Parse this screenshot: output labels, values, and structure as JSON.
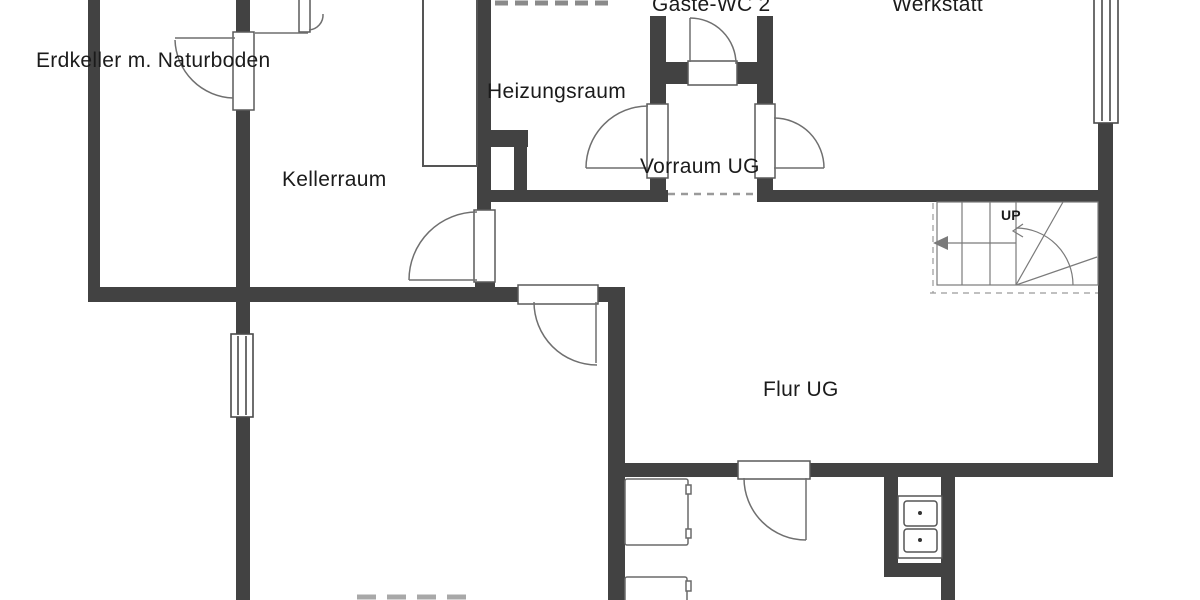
{
  "plan_type": "floor-plan",
  "rooms": {
    "erdkeller": {
      "label": "Erdkeller m. Naturboden"
    },
    "kellerraum": {
      "label": "Kellerraum"
    },
    "heizungsraum": {
      "label": "Heizungsraum"
    },
    "gaeste_wc": {
      "label": "Gäste-WC 2"
    },
    "werkstatt": {
      "label": "Werkstatt"
    },
    "vorraum": {
      "label": "Vorraum UG"
    },
    "flur": {
      "label": "Flur UG"
    }
  },
  "stairs": {
    "direction_label": "UP"
  },
  "colors": {
    "background": "#ffffff",
    "wall": "#424242",
    "door_outline": "#5a5a5a",
    "swing_arc": "#6f6f6f",
    "stair_line": "#7a7a7a",
    "dashed_opening": "#9a9a9a",
    "text": "#1b1b1b"
  }
}
